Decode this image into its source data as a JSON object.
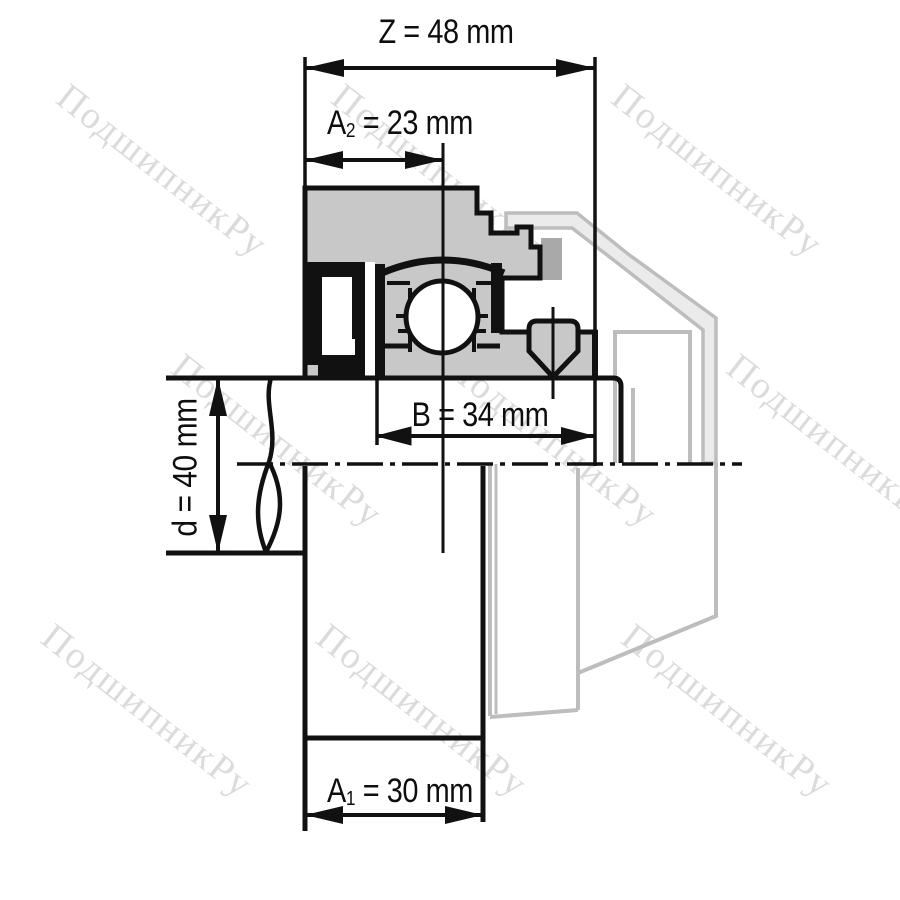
{
  "watermark": {
    "text": "ПодшипникРу"
  },
  "dimensions": {
    "z": {
      "letter": "Z",
      "sub": "",
      "tail": " = 48 mm",
      "value": 48,
      "unit": "mm"
    },
    "a2": {
      "letter": "A",
      "sub": "2",
      "tail": " = 23 mm",
      "value": 23,
      "unit": "mm"
    },
    "b": {
      "letter": "B",
      "sub": "",
      "tail": " = 34 mm",
      "value": 34,
      "unit": "mm"
    },
    "d": {
      "letter": "d",
      "sub": "",
      "tail": " = 40 mm",
      "value": 40,
      "unit": "mm"
    },
    "a1": {
      "letter": "A",
      "sub": "1",
      "tail": " = 30 mm",
      "value": 30,
      "unit": "mm"
    }
  },
  "colors": {
    "drawing_black": "#111111",
    "steel_gray": "#c8c8c8",
    "ghost_stroke": "#bdbdbd",
    "ghost_fill": "#ebebeb",
    "ghost_dark_block": "#a9a9a9",
    "background": "#ffffff"
  }
}
